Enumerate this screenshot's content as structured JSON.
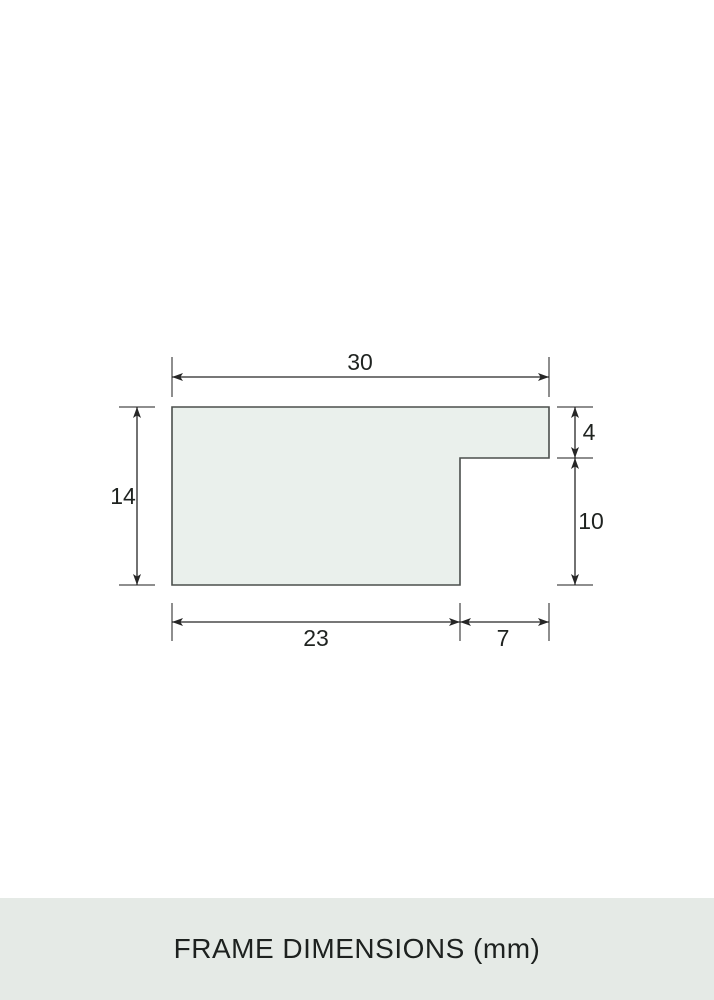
{
  "banner": {
    "title": "FRAME DIMENSIONS (mm)"
  },
  "diagram": {
    "description": "Stepped cross-section profile of a picture frame moulding with dimension lines",
    "unit": "mm",
    "dimensions": {
      "overall_width": {
        "label": "30",
        "value": 30
      },
      "overall_height": {
        "label": "14",
        "value": 14
      },
      "front_lip_height": {
        "label": "4",
        "value": 4
      },
      "rabbet_height": {
        "label": "10",
        "value": 10
      },
      "body_width": {
        "label": "23",
        "value": 23
      },
      "rabbet_width": {
        "label": "7",
        "value": 7
      }
    },
    "colors": {
      "shape_fill": "#eaf0ec",
      "shape_outline": "#4b4f4c",
      "dimension_line": "#262626",
      "extension_tick": "#8e8e8e",
      "label_text": "#1f2320",
      "banner_background": "#e5eae6",
      "banner_text": "#1d211f",
      "page_background": "#ffffff"
    }
  }
}
